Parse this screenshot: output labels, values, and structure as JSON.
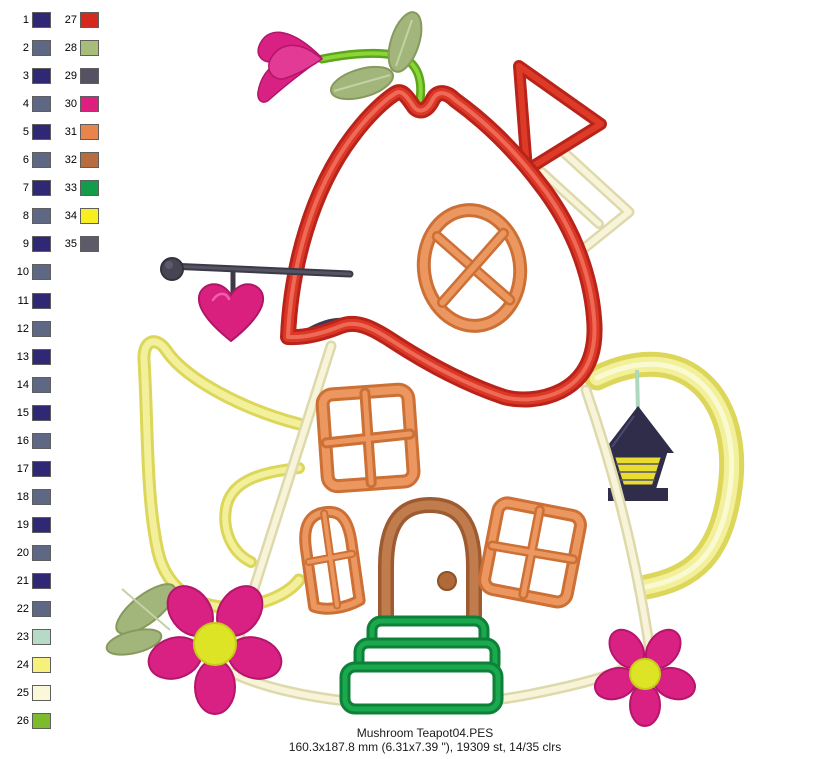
{
  "window": {
    "background": "#ffffff"
  },
  "palette": {
    "entries": [
      {
        "number": 1,
        "color": "#2e2875"
      },
      {
        "number": 2,
        "color": "#5e6884"
      },
      {
        "number": 3,
        "color": "#2e2875"
      },
      {
        "number": 4,
        "color": "#5e6884"
      },
      {
        "number": 5,
        "color": "#2e2875"
      },
      {
        "number": 6,
        "color": "#5e6884"
      },
      {
        "number": 7,
        "color": "#2e2875"
      },
      {
        "number": 8,
        "color": "#5e6884"
      },
      {
        "number": 9,
        "color": "#2e2875"
      },
      {
        "number": 10,
        "color": "#5e6884"
      },
      {
        "number": 11,
        "color": "#2e2875"
      },
      {
        "number": 12,
        "color": "#5e6884"
      },
      {
        "number": 13,
        "color": "#2e2875"
      },
      {
        "number": 14,
        "color": "#5e6884"
      },
      {
        "number": 15,
        "color": "#2e2875"
      },
      {
        "number": 16,
        "color": "#5e6884"
      },
      {
        "number": 17,
        "color": "#2e2875"
      },
      {
        "number": 18,
        "color": "#5e6884"
      },
      {
        "number": 19,
        "color": "#2e2875"
      },
      {
        "number": 20,
        "color": "#5e6884"
      },
      {
        "number": 21,
        "color": "#2e2875"
      },
      {
        "number": 22,
        "color": "#5e6884"
      },
      {
        "number": 23,
        "color": "#b7dac6"
      },
      {
        "number": 24,
        "color": "#f6f07d"
      },
      {
        "number": 25,
        "color": "#fbf8da"
      },
      {
        "number": 26,
        "color": "#7cbb2c"
      },
      {
        "number": 27,
        "color": "#d5291f"
      },
      {
        "number": 28,
        "color": "#a6bd7b"
      },
      {
        "number": 29,
        "color": "#575263"
      },
      {
        "number": 30,
        "color": "#de1f80"
      },
      {
        "number": 31,
        "color": "#e8854c"
      },
      {
        "number": 32,
        "color": "#b76d3f"
      },
      {
        "number": 33,
        "color": "#139c4a"
      },
      {
        "number": 34,
        "color": "#f8ee20"
      },
      {
        "number": 35,
        "color": "#5d5a69"
      }
    ]
  },
  "design": {
    "subject": "mushroom teapot house applique embroidery preview",
    "colors": {
      "cap_red": "#d63122",
      "body_cream": "#f2eed2",
      "spout_handle_yellow": "#eeea7c",
      "window_orange": "#e0823f",
      "door_brown": "#b06a3a",
      "stairs_green": "#149a47",
      "flower_pink": "#d92083",
      "flower_center_yellow": "#dde426",
      "leaf_sage": "#a2b67b",
      "stem_green": "#76c22a",
      "lantern_navy": "#2f2d49",
      "sign_gray": "#474553",
      "cord_mint": "#abd8bf"
    }
  },
  "footer": {
    "filename": "Mushroom Teapot04.PES",
    "details": "160.3x187.8 mm (6.31x7.39 \"), 19309 st, 14/35 clrs"
  }
}
